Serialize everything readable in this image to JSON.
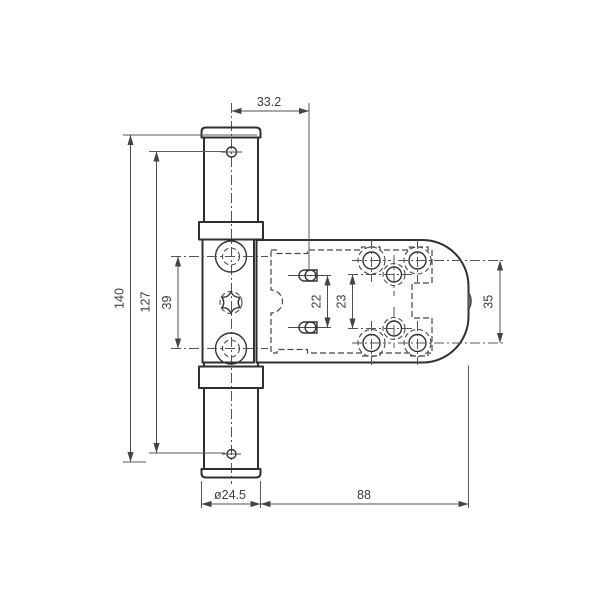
{
  "drawing": {
    "type": "technical-drawing",
    "subject": "rebate door hinge, dimensioned engineering drawing",
    "units": "mm",
    "colors": {
      "background": "#ffffff",
      "outline": "#2f2f2f",
      "dimension_lines": "#4f4f4f",
      "text": "#3d3d3d"
    },
    "dimensions": {
      "pivot_to_stud": "33.2",
      "barrel_length": "140",
      "fixing_hole_spacing": "127",
      "leaf_hole_spacing": "39",
      "stud_spacing": "22",
      "plate_hole_spacing": "23",
      "flange_hole_spacing": "35",
      "barrel_diameter": "ø24.5",
      "flange_length": "88"
    }
  }
}
